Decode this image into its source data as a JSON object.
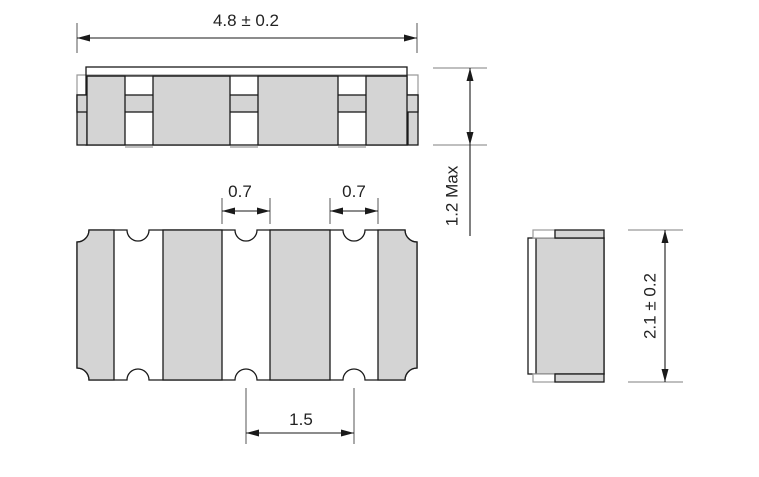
{
  "drawing": {
    "type": "component-package-dimensional-drawing",
    "views": {
      "front_view": "front-view",
      "bottom_view": "bottom-view",
      "side_view": "side-view"
    }
  },
  "dimensions": {
    "overall_width": "4.8 ± 0.2",
    "max_height": "1.2 Max",
    "notch_width_left": "0.7",
    "notch_width_right": "0.7",
    "notch_pitch": "1.5",
    "body_depth": "2.1 ± 0.2"
  },
  "colors": {
    "part_fill": "#d4d4d4",
    "line": "#1a1a1a",
    "extension_dark": "#555555",
    "extension_light": "#999999",
    "body_outline": "#9a9a9a",
    "text": "#222222",
    "background": "#ffffff"
  }
}
